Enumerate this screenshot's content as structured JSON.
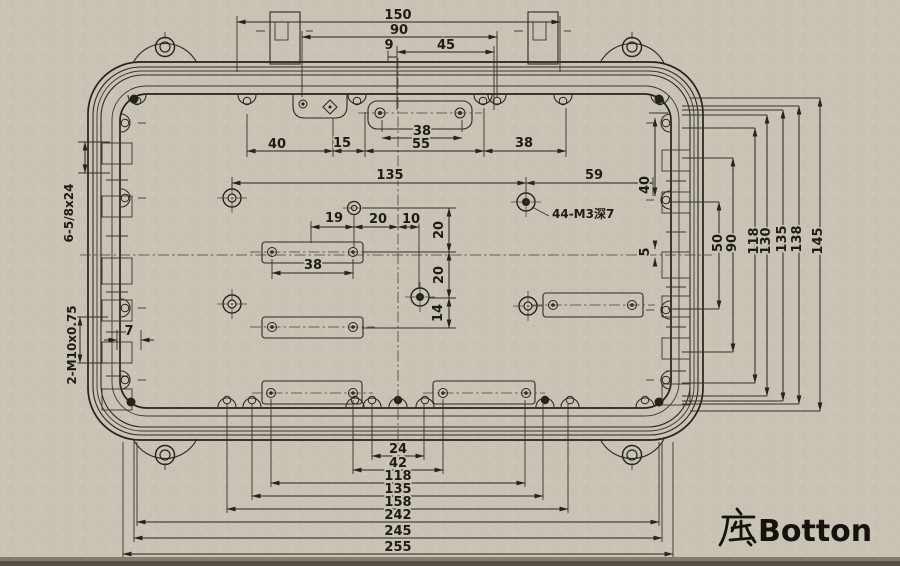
{
  "sheet": {
    "caption": {
      "full": "底Botton",
      "hanzi": "底",
      "latin": "Botton"
    },
    "callouts": {
      "tapped_holes": "44-M3深7",
      "side_thread": "6-5/8x24",
      "gland_thread": "2-M10x0.75"
    },
    "dimensions": {
      "top": [
        "150",
        "90",
        "9",
        "45"
      ],
      "upper_row": [
        "40",
        "15",
        "38",
        "55",
        "38"
      ],
      "middle": [
        "135",
        "59",
        "19",
        "20",
        "10",
        "38"
      ],
      "middle_vertical": [
        "20",
        "20",
        "14"
      ],
      "left": [
        "7"
      ],
      "right_vertical": [
        "40",
        "5",
        "50",
        "90",
        "118",
        "130",
        "135",
        "138",
        "145"
      ],
      "bottom": [
        "24",
        "42",
        "118",
        "135",
        "158",
        "242",
        "245",
        "255"
      ]
    },
    "labels": [
      {
        "text": "150"
      },
      {
        "text": "90"
      },
      {
        "text": "9"
      },
      {
        "text": "45"
      },
      {
        "text": "38"
      },
      {
        "text": "40"
      },
      {
        "text": "15"
      },
      {
        "text": "55"
      },
      {
        "text": "38"
      },
      {
        "text": "135"
      },
      {
        "text": "59"
      },
      {
        "text": "44-M3深7"
      },
      {
        "text": "19"
      },
      {
        "text": "20"
      },
      {
        "text": "10"
      },
      {
        "text": "20"
      },
      {
        "text": "20"
      },
      {
        "text": "14"
      },
      {
        "text": "38"
      },
      {
        "text": "6-5/8x24"
      },
      {
        "text": "7"
      },
      {
        "text": "2-M10x0.75"
      },
      {
        "text": "40"
      },
      {
        "text": "5"
      },
      {
        "text": "50"
      },
      {
        "text": "90"
      },
      {
        "text": "118"
      },
      {
        "text": "130"
      },
      {
        "text": "135"
      },
      {
        "text": "138"
      },
      {
        "text": "145"
      },
      {
        "text": "24"
      },
      {
        "text": "42"
      },
      {
        "text": "118"
      },
      {
        "text": "135"
      },
      {
        "text": "158"
      },
      {
        "text": "242"
      },
      {
        "text": "245"
      },
      {
        "text": "255"
      }
    ]
  }
}
